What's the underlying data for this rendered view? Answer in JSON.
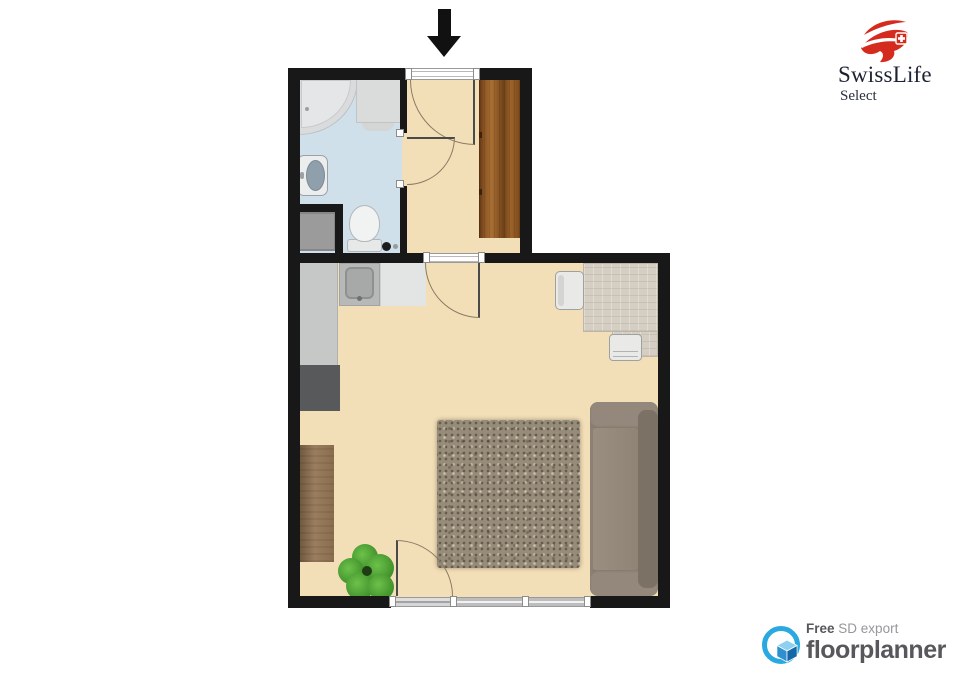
{
  "branding": {
    "swisslife": {
      "name": "SwissLife",
      "product": "Select",
      "brand_red": "#d52b1e",
      "text_navy": "#1d2134"
    },
    "floorplanner": {
      "free_label": "Free",
      "export_label": "SD export",
      "brand": "floorplanner",
      "brand_blue": "#2aa9e0",
      "text_dark": "#57585c",
      "text_gray": "#95979a"
    }
  },
  "floorplan": {
    "orientation_arrow": "entrance-at-top",
    "wall_color": "#181818",
    "rooms": [
      {
        "name": "bathroom",
        "floor_color": "#cfe0ea",
        "furniture": [
          "corner-bathtub",
          "shower-cabinet",
          "washbasin",
          "toilet",
          "washing-machine",
          "floor-drain"
        ]
      },
      {
        "name": "hallway",
        "floor_color": "#f3dfb7",
        "furniture": [
          "wardrobe"
        ],
        "doors": [
          "entrance-door",
          "bathroom-door",
          "living-room-door"
        ]
      },
      {
        "name": "living-room",
        "floor_color": "#f3dfb7",
        "furniture": [
          "kitchen-counter",
          "kitchen-sink",
          "refrigerator",
          "desk",
          "desk-chair",
          "side-chair",
          "sofa",
          "rug",
          "sideboard",
          "plant"
        ],
        "doors": [
          "balcony-door"
        ],
        "windows": [
          "window-bottom"
        ]
      }
    ]
  }
}
